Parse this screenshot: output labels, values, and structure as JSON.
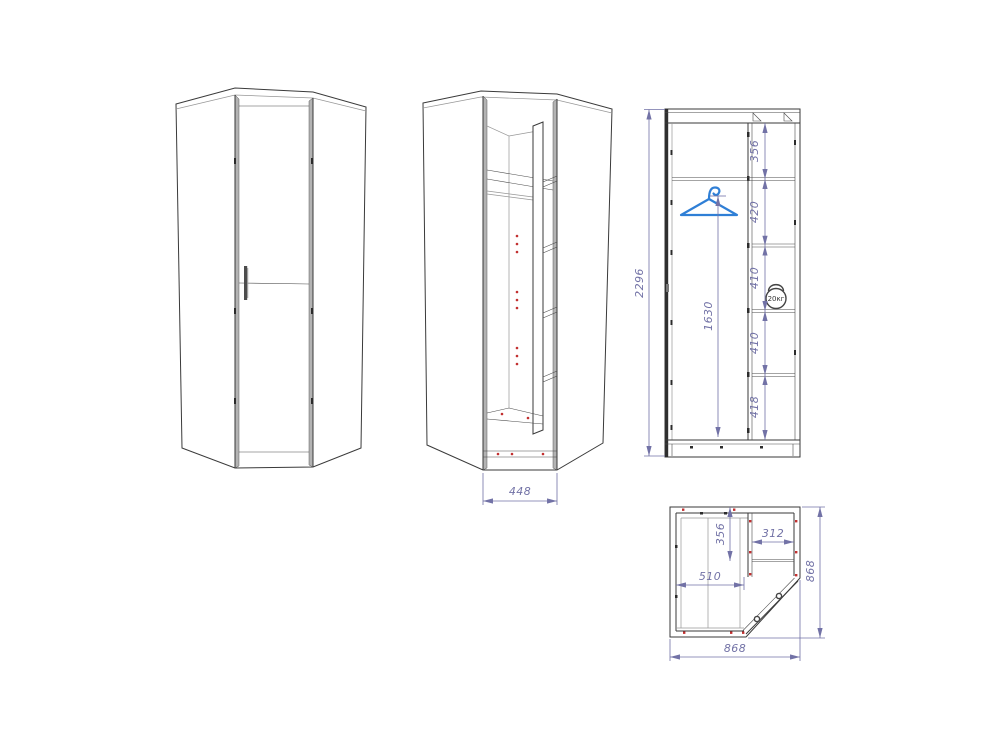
{
  "drawing": {
    "type": "furniture-technical-drawing",
    "subject": "corner-wardrobe",
    "views": {
      "front_closed": {
        "name": "front-view-door-closed"
      },
      "front_open": {
        "name": "front-view-door-open",
        "dim_opening_width": "448"
      },
      "side_section": {
        "name": "side-section-view",
        "dim_overall_height": "2296",
        "dim_rod_height": "1630",
        "dim_chain": [
          "356",
          "420",
          "410",
          "410",
          "418"
        ],
        "weight_badge": "20кг"
      },
      "plan": {
        "name": "plan-top-view",
        "dim_shelf_depth": "356",
        "dim_shelf_width": "312",
        "dim_inner_width": "510",
        "dim_overall_width": "868",
        "dim_overall_depth": "868"
      }
    },
    "icons": {
      "hanger": "clothes-hanger-icon",
      "weight": "kettlebell-weight-icon"
    },
    "colors": {
      "line": "#3a3a3a",
      "line_light": "#979797",
      "dimension": "#7272a6",
      "hanger_blue": "#2f7fd6",
      "fastener_red": "#c23030",
      "background": "#ffffff"
    }
  }
}
